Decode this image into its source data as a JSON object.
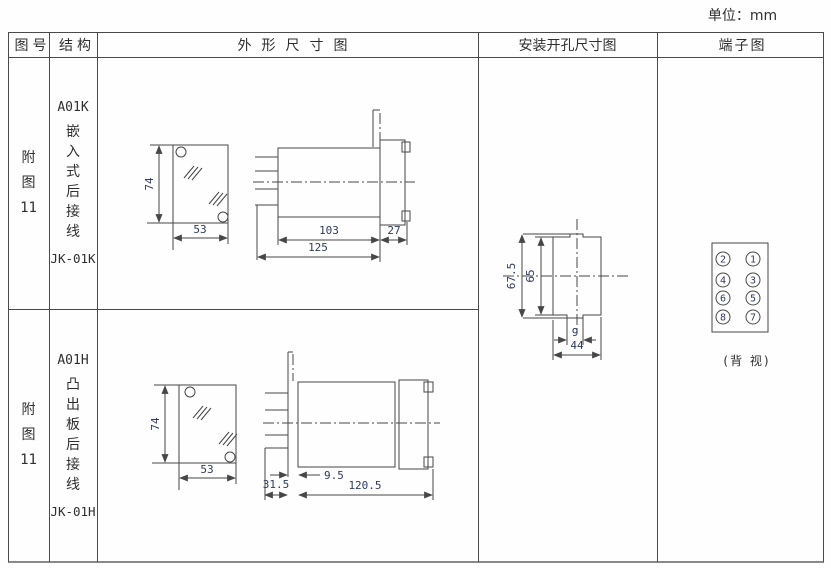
{
  "unit_label": "单位：mm",
  "headers": {
    "figure_no": "图号",
    "structure": "结构",
    "outline": "外形尺寸图",
    "cutout": "安装开孔尺寸图",
    "terminal": "端子图"
  },
  "rows": [
    {
      "figure_no_lines": [
        "附",
        "图",
        "11"
      ],
      "model": "A01K",
      "desc_chars": [
        "嵌",
        "入",
        "式",
        "后",
        "接",
        "线"
      ],
      "code": "JK-01K",
      "dims": {
        "height": "74",
        "width": "53",
        "body": "103",
        "flange": "27",
        "total": "125"
      }
    },
    {
      "figure_no_lines": [
        "附",
        "图",
        "11"
      ],
      "model": "A01H",
      "desc_chars": [
        "凸",
        "出",
        "板",
        "后",
        "接",
        "线"
      ],
      "code": "JK-01H",
      "dims": {
        "height": "74",
        "width": "53",
        "panel_gap": "9.5",
        "body": "120.5",
        "pins": "31.5"
      }
    }
  ],
  "cutout": {
    "outer_height": "67.5",
    "inner_height": "65",
    "notch_width": "9",
    "width": "44"
  },
  "terminal": {
    "left_column": [
      "2",
      "4",
      "6",
      "8"
    ],
    "right_column": [
      "1",
      "3",
      "5",
      "7"
    ],
    "caption": "(背 视)"
  }
}
